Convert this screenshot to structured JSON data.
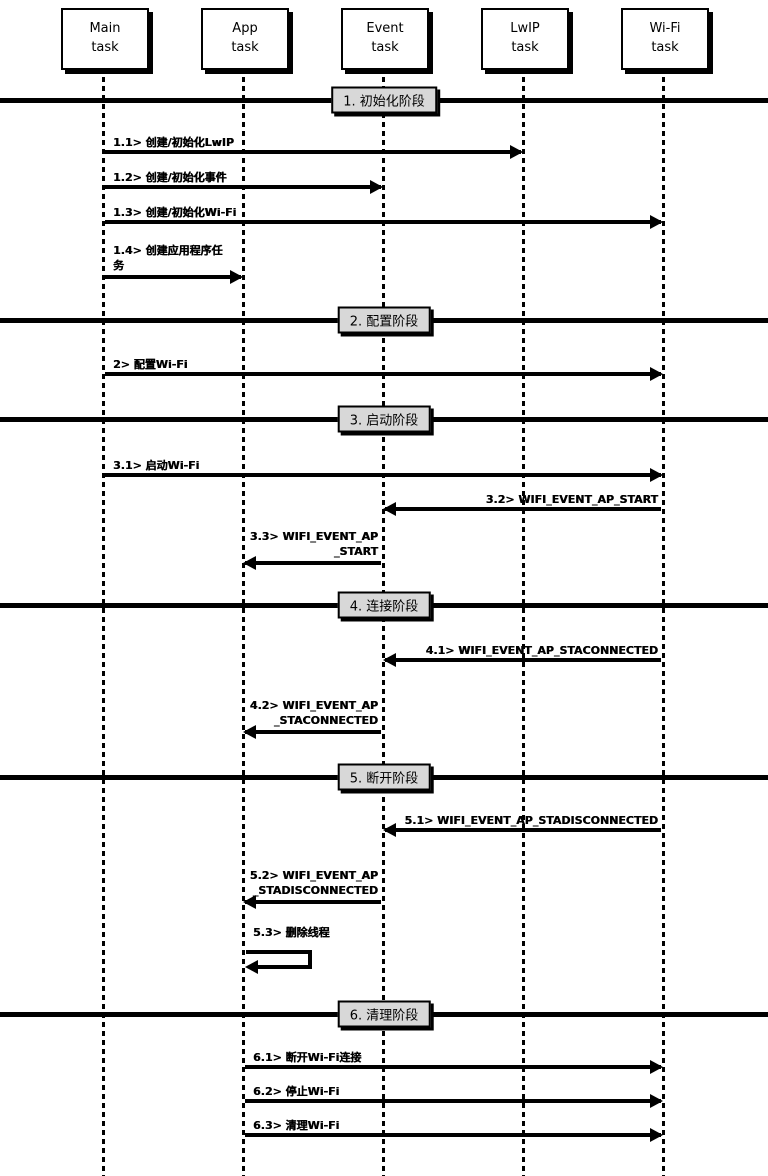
{
  "actors": [
    {
      "name": "Main task",
      "line1": "Main",
      "line2": "task"
    },
    {
      "name": "App task",
      "line1": "App",
      "line2": "task"
    },
    {
      "name": "Event task",
      "line1": "Event",
      "line2": "task"
    },
    {
      "name": "LwIP task",
      "line1": "LwIP",
      "line2": "task"
    },
    {
      "name": "Wi-Fi task",
      "line1": "Wi-Fi",
      "line2": "task"
    }
  ],
  "phases": [
    {
      "label": "1. 初始化阶段"
    },
    {
      "label": "2. 配置阶段"
    },
    {
      "label": "3. 启动阶段"
    },
    {
      "label": "4. 连接阶段"
    },
    {
      "label": "5. 断开阶段"
    },
    {
      "label": "6. 清理阶段"
    }
  ],
  "messages": [
    {
      "id": "1.1",
      "from": "Main task",
      "to": "LwIP task",
      "label": "1.1> 创建/初始化LwIP"
    },
    {
      "id": "1.2",
      "from": "Main task",
      "to": "Event task",
      "label": "1.2> 创建/初始化事件"
    },
    {
      "id": "1.3",
      "from": "Main task",
      "to": "Wi-Fi task",
      "label": "1.3> 创建/初始化Wi-Fi"
    },
    {
      "id": "1.4",
      "from": "Main task",
      "to": "App task",
      "label": "1.4> 创建应用程序任",
      "label2": "务"
    },
    {
      "id": "2",
      "from": "Main task",
      "to": "Wi-Fi task",
      "label": "2> 配置Wi-Fi"
    },
    {
      "id": "3.1",
      "from": "Main task",
      "to": "Wi-Fi task",
      "label": "3.1> 启动Wi-Fi"
    },
    {
      "id": "3.2",
      "from": "Wi-Fi task",
      "to": "Event task",
      "label": "3.2> WIFI_EVENT_AP_START"
    },
    {
      "id": "3.3",
      "from": "Event task",
      "to": "App task",
      "label": "3.3> WIFI_EVENT_AP",
      "label2": "_START"
    },
    {
      "id": "4.1",
      "from": "Wi-Fi task",
      "to": "Event task",
      "label": "4.1> WIFI_EVENT_AP_STACONNECTED"
    },
    {
      "id": "4.2",
      "from": "Event task",
      "to": "App task",
      "label": "4.2> WIFI_EVENT_AP",
      "label2": "_STACONNECTED"
    },
    {
      "id": "5.1",
      "from": "Wi-Fi task",
      "to": "Event task",
      "label": "5.1> WIFI_EVENT_AP_STADISCONNECTED"
    },
    {
      "id": "5.2",
      "from": "Event task",
      "to": "App task",
      "label": "5.2> WIFI_EVENT_AP",
      "label2": "_STADISCONNECTED"
    },
    {
      "id": "5.3",
      "from": "App task",
      "to": "App task",
      "label": "5.3> 删除线程"
    },
    {
      "id": "6.1",
      "from": "App task",
      "to": "Wi-Fi task",
      "label": "6.1> 断开Wi-Fi连接"
    },
    {
      "id": "6.2",
      "from": "App task",
      "to": "Wi-Fi task",
      "label": "6.2> 停止Wi-Fi"
    },
    {
      "id": "6.3",
      "from": "App task",
      "to": "Wi-Fi task",
      "label": "6.3> 清理Wi-Fi"
    }
  ],
  "colors": {
    "line": "#000000",
    "phase_label_bg": "#d8d8d8",
    "actor_bg": "#ffffff",
    "background": "#ffffff"
  }
}
